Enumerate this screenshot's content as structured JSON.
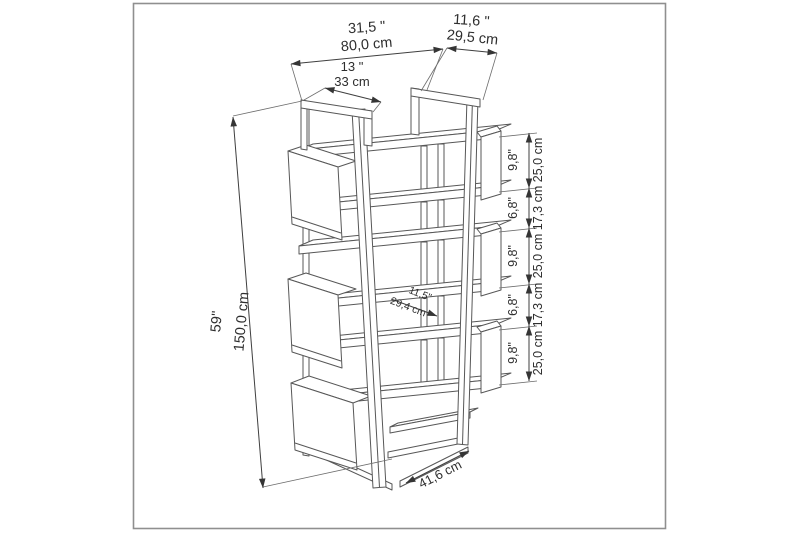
{
  "diagram": {
    "subject": "bookcase-dimension-drawing",
    "dims": {
      "width": {
        "in": "31,5 \"",
        "cm": "80,0 cm"
      },
      "depth": {
        "in": "11,6 \"",
        "cm": "29,5 cm"
      },
      "top": {
        "in": "13 \"",
        "cm": "33 cm"
      },
      "height": {
        "in": "59\"",
        "cm": "150,0 cm"
      },
      "segments": [
        {
          "in": "9,8\"",
          "cm": "25,0 cm"
        },
        {
          "in": "6,8\"",
          "cm": "17,3 cm"
        },
        {
          "in": "9,8\"",
          "cm": "25,0 cm"
        },
        {
          "in": "6,8\"",
          "cm": "17,3 cm"
        },
        {
          "in": "9,8\"",
          "cm": "25,0 cm"
        }
      ],
      "shelf": {
        "in": "11,5\"",
        "cm": "29,4 cm"
      },
      "base": {
        "cm": "41,6 cm"
      }
    },
    "colors": {
      "line": "#575757",
      "dimension": "#3f3f3f",
      "text": "#2e2e2e",
      "border": "#8f8f8f",
      "background": "#ffffff"
    }
  }
}
